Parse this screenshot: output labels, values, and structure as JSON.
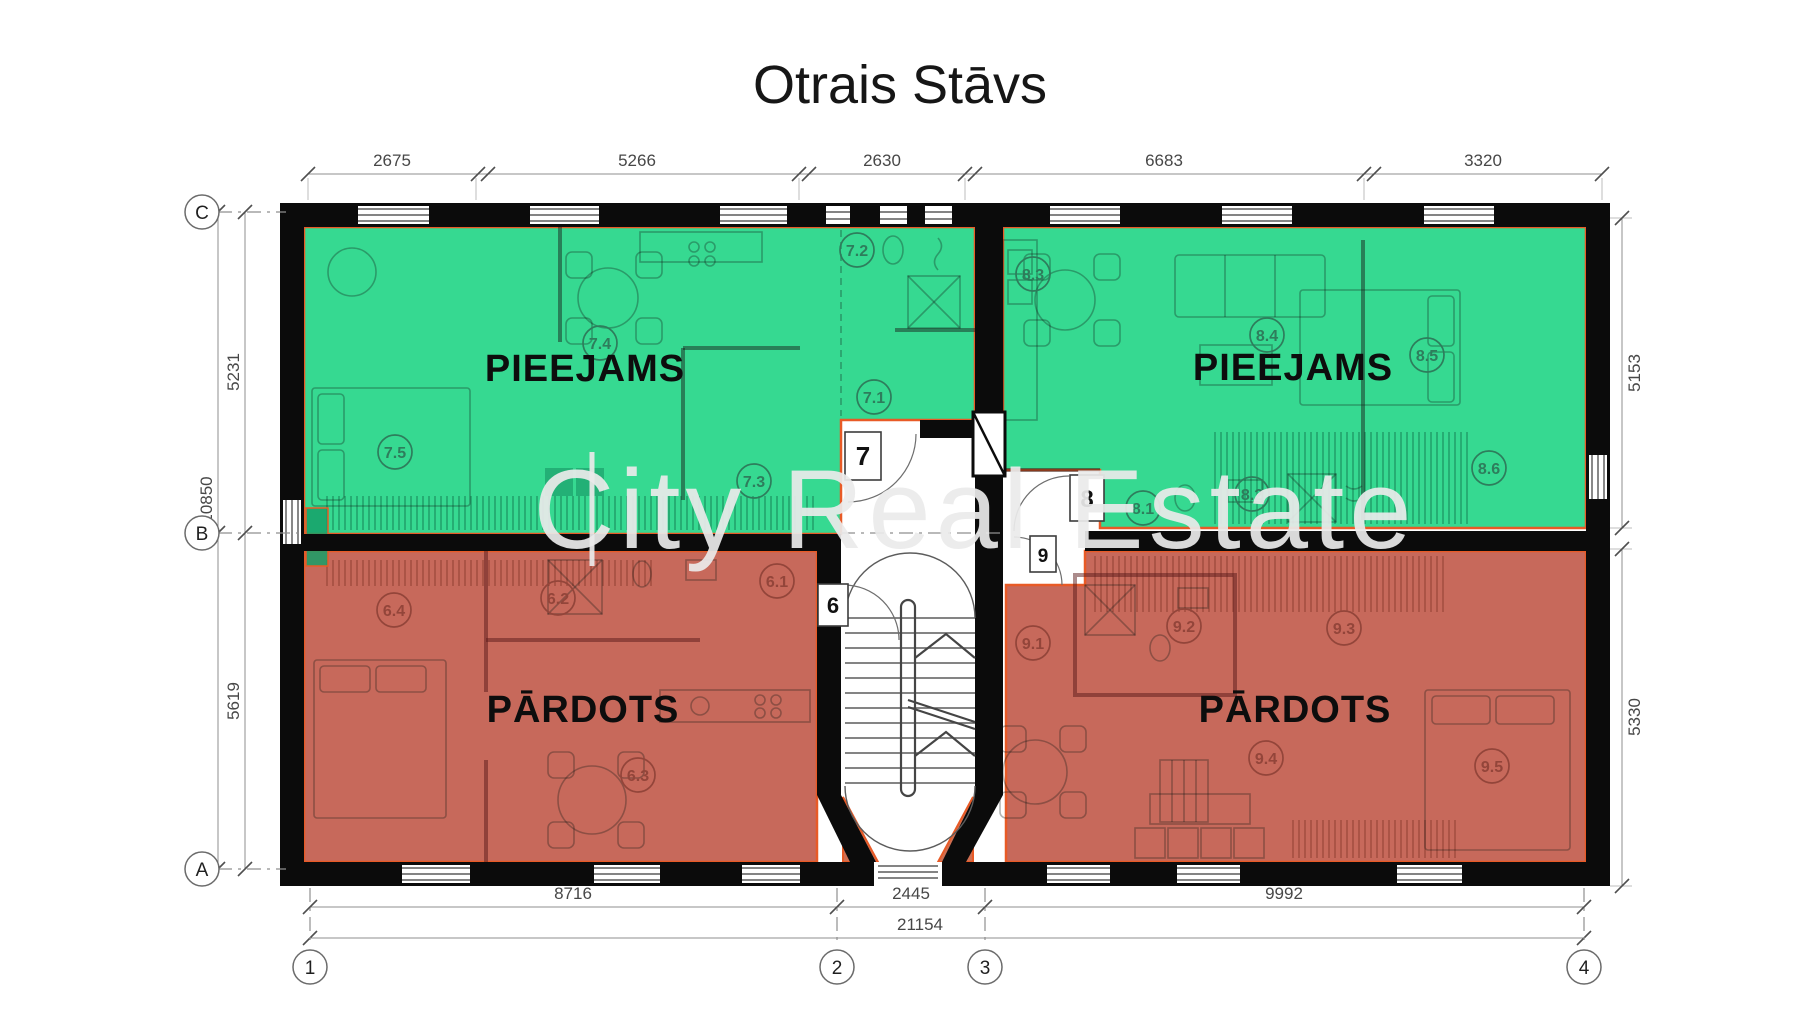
{
  "page": {
    "title": "Otrais Stāvs",
    "watermark": "City Real Estate"
  },
  "colors": {
    "available_fill": "#36d991",
    "sold_fill": "#c7695b",
    "unit_outline": "#e85a26",
    "wall": "#0b0b0b",
    "dimension_gray": "#8f8f8f"
  },
  "dimensions": {
    "top": [
      "2675",
      "5266",
      "2630",
      "6683",
      "3320"
    ],
    "left_inner": [
      "5231",
      "5619"
    ],
    "left_outer": "10850",
    "right": [
      "5153",
      "5330"
    ],
    "bottom": [
      "8716",
      "2445",
      "9992"
    ],
    "total": "21154"
  },
  "grid_axes": {
    "rows": [
      "C",
      "B",
      "A"
    ],
    "cols": [
      "1",
      "2",
      "3",
      "4"
    ]
  },
  "units": [
    {
      "id": "7",
      "status_label": "PIEEJAMS",
      "rooms": [
        "7.1",
        "7.2",
        "7.3",
        "7.4",
        "7.5"
      ]
    },
    {
      "id": "8",
      "status_label": "PIEEJAMS",
      "rooms": [
        "8.1",
        "8.2",
        "8.3",
        "8.4",
        "8.5",
        "8.6"
      ]
    },
    {
      "id": "6",
      "status_label": "PĀRDOTS",
      "rooms": [
        "6.1",
        "6.2",
        "6.3",
        "6.4"
      ]
    },
    {
      "id": "9",
      "status_label": "PĀRDOTS",
      "rooms": [
        "9.1",
        "9.2",
        "9.3",
        "9.4",
        "9.5"
      ]
    }
  ]
}
